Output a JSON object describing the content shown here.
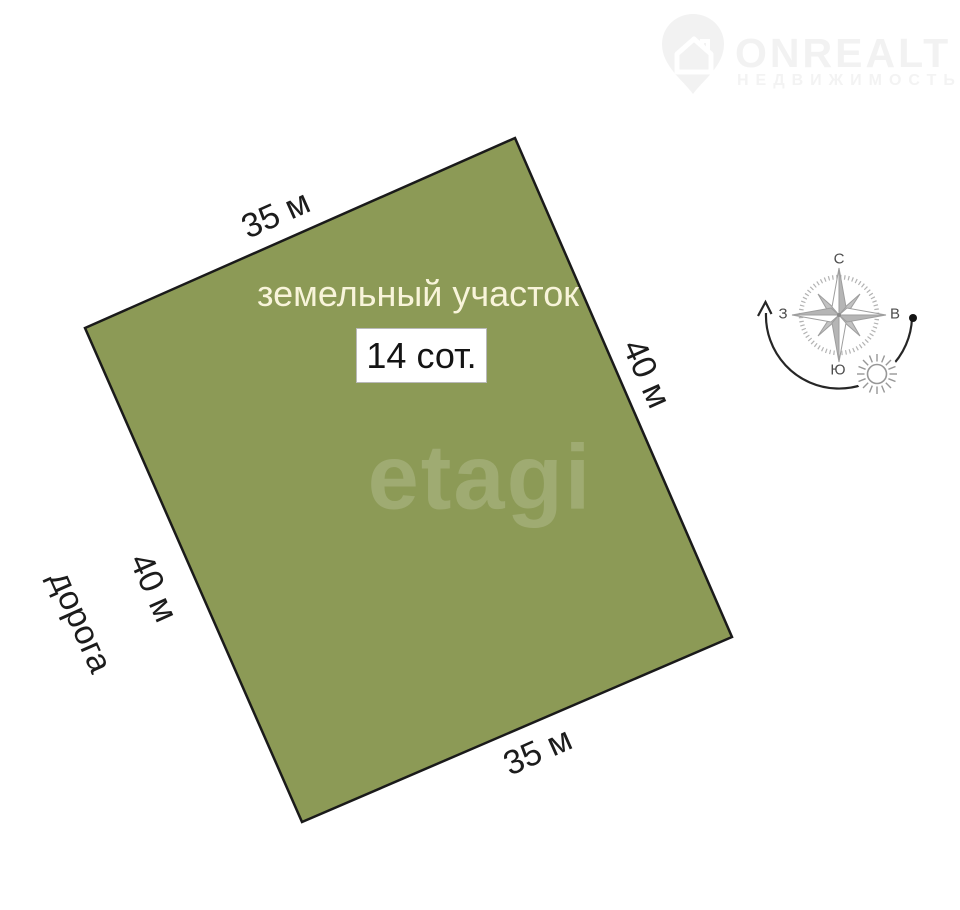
{
  "logo": {
    "brand": "ONREALT",
    "tagline": "НЕДВИЖИМОСТЬ"
  },
  "plot": {
    "label": "земельный участок",
    "area_label": "14 сот.",
    "watermark": "etagi",
    "fill_color": "#8c9a56",
    "border_color": "#1a1a1a",
    "top_side": "35 м",
    "right_side": "40 м",
    "bottom_side": "35 м",
    "left_side": "40 м"
  },
  "road": {
    "label": "дорога"
  },
  "compass": {
    "north": "С",
    "east": "В",
    "south": "Ю",
    "west": "З"
  }
}
